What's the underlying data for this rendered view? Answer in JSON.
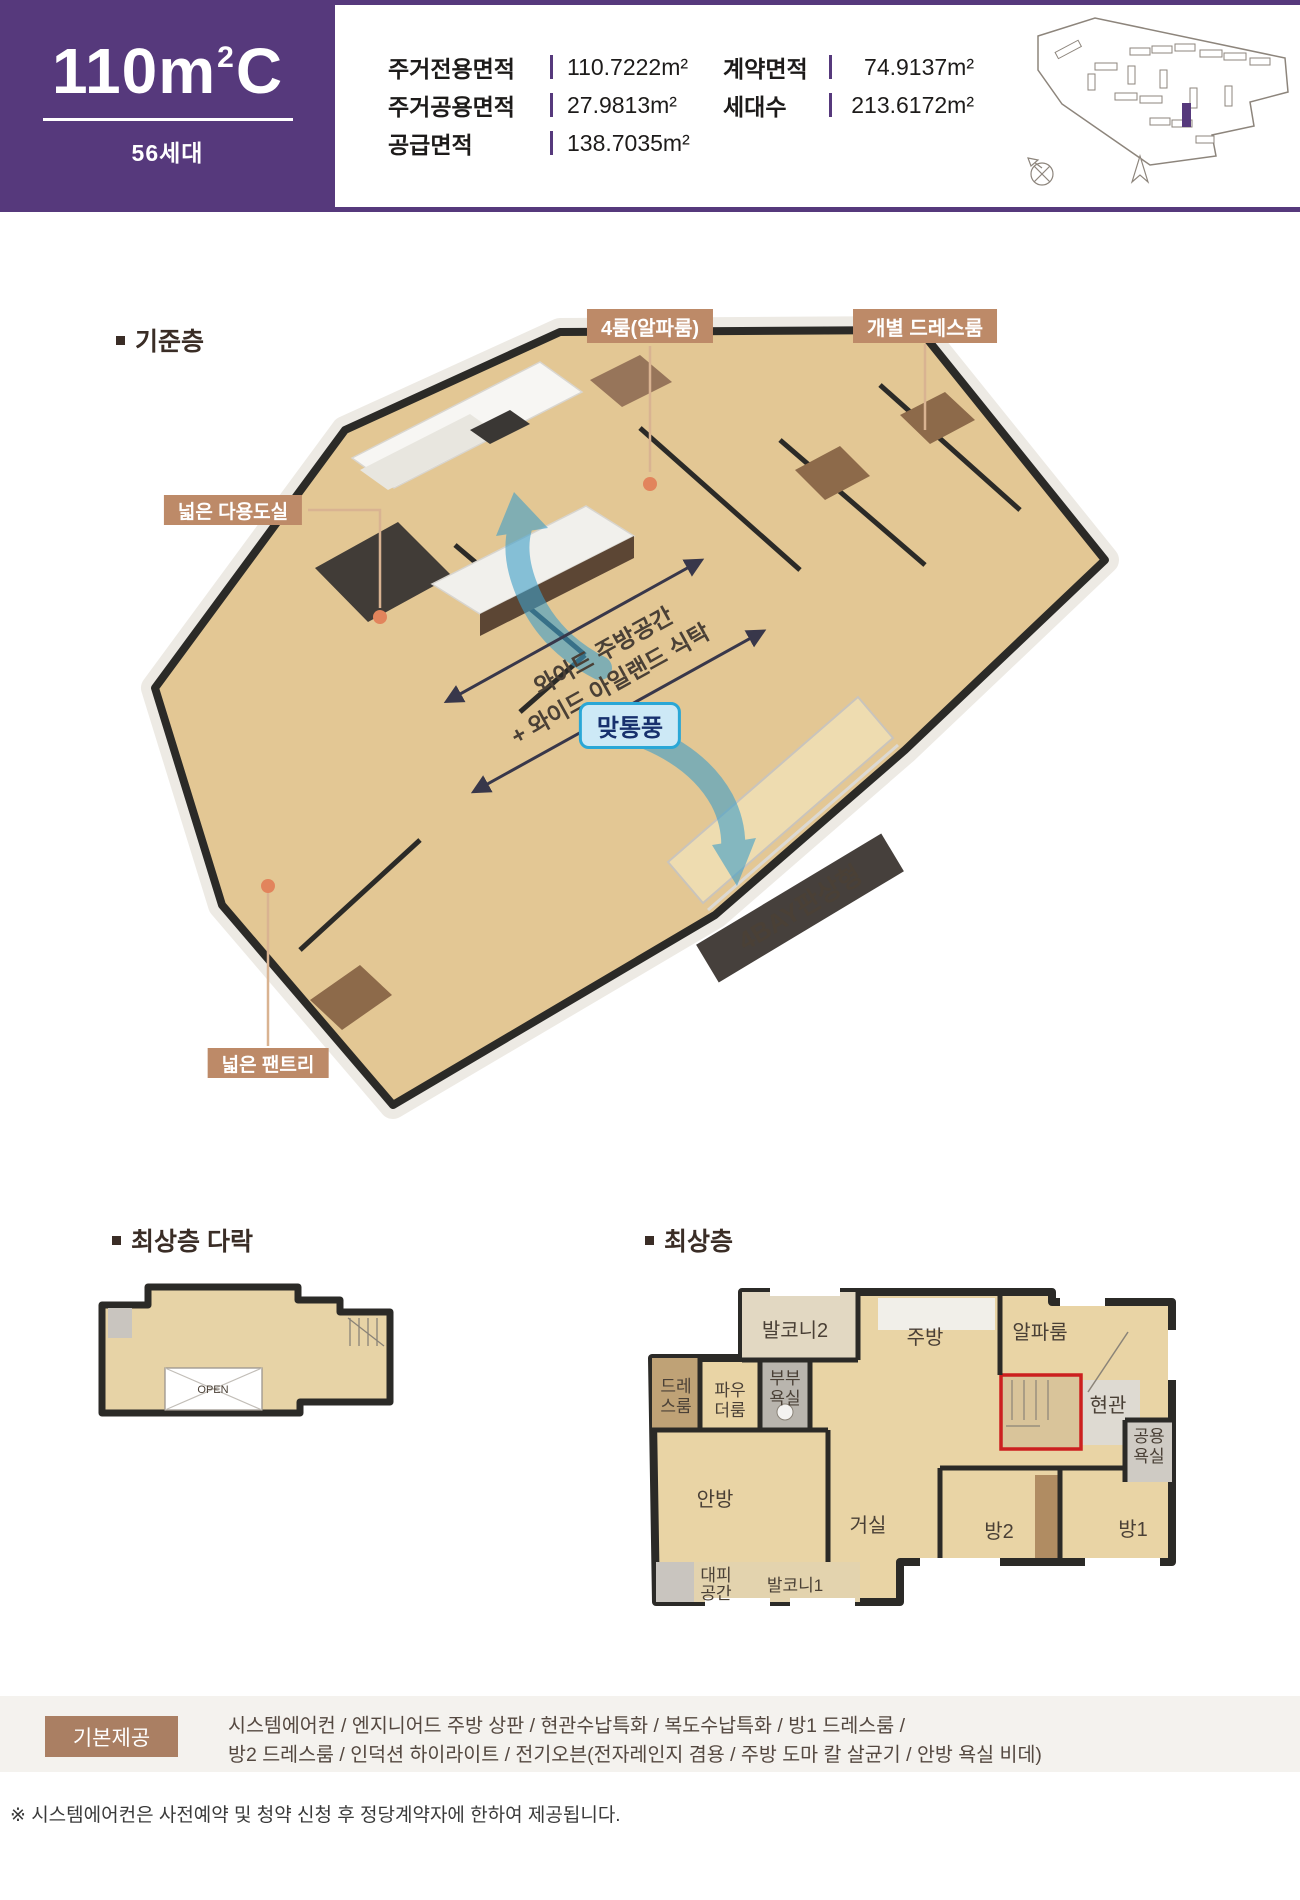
{
  "colors": {
    "purple": "#56397c",
    "callout_tan": "#bd8a68",
    "connector_tan": "#d9b391",
    "dot_orange": "#e2845c",
    "banner_dark": "#46403c",
    "annotation_navy": "#38374a",
    "badge_bg": "#cde9f6",
    "badge_border": "#2aa7d6",
    "badge_text": "#17306d",
    "arrow_blue": "#3f9fc9",
    "wall_dark": "#2b2a27",
    "floor_wood": "#e3c794",
    "provided_box": "#aa7f63",
    "provided_band": "#f4f2ee",
    "title_brown": "#3a2d26"
  },
  "header": {
    "unit_number": "110",
    "unit_unit": "m",
    "unit_sup": "2",
    "unit_type": "C",
    "households": "56세대",
    "specs_left": [
      {
        "label": "주거전용면적",
        "value": "110.7222m²"
      },
      {
        "label": "주거공용면적",
        "value": "27.9813m²"
      },
      {
        "label": "공급면적",
        "value": "138.7035m²"
      }
    ],
    "specs_right": [
      {
        "label": "계약면적",
        "value": "74.9137m²"
      },
      {
        "label": "세대수",
        "value": "213.6172m²"
      }
    ]
  },
  "floor3d": {
    "section_title": "기준층",
    "callout_alpha": "4룸(알파룸)",
    "callout_dress": "개별 드레스룸",
    "callout_utility": "넓은 다용도실",
    "callout_pantry": "넓은 팬트리",
    "annotation_line1": "와이드 주방공간",
    "annotation_line2": "+ 와이드 아일랜드 식탁",
    "vent_badge": "맞통풍",
    "bay_banner": "4BAY판상형"
  },
  "attic": {
    "section_title": "최상층 다락",
    "open_label": "OPEN"
  },
  "top_floor": {
    "section_title": "최상층",
    "rooms": {
      "balcony2": "발코니2",
      "kitchen": "주방",
      "alpha": "알파룸",
      "dress_l1": "드레",
      "dress_l2": "스룸",
      "powder_l1": "파우",
      "powder_l2": "더룸",
      "bath_l1": "부부",
      "bath_l2": "욕실",
      "entrance": "현관",
      "pubbath_l1": "공용",
      "pubbath_l2": "욕실",
      "master": "안방",
      "living": "거실",
      "room2": "방2",
      "room1": "방1",
      "shelter_l1": "대피",
      "shelter_l2": "공간",
      "balcony1": "발코니1"
    }
  },
  "provided": {
    "label": "기본제공",
    "line1": "시스템에어컨 / 엔지니어드 주방 상판 / 현관수납특화 / 복도수납특화 / 방1 드레스룸 /",
    "line2": "방2 드레스룸 / 인덕션 하이라이트 / 전기오븐(전자레인지 겸용 / 주방 도마 칼 살균기 / 안방 욕실 비데)"
  },
  "footnote": "※ 시스템에어컨은 사전예약 및 청약 신청 후 정당계약자에 한하여 제공됩니다."
}
